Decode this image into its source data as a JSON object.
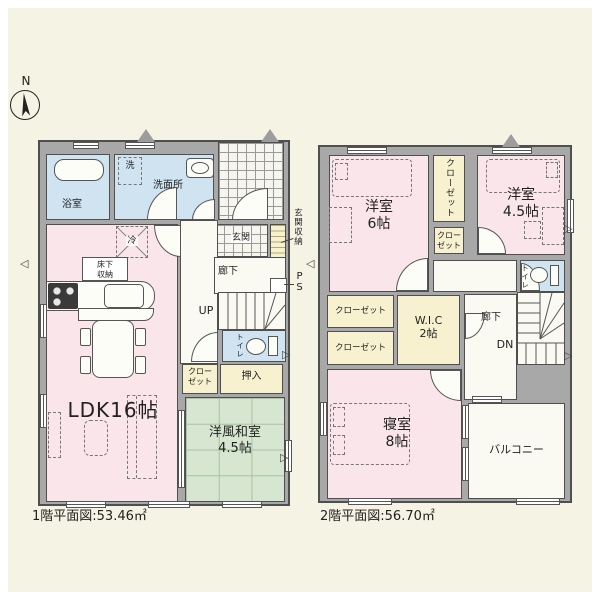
{
  "compass": {
    "north": "N"
  },
  "floor1": {
    "caption": "1階平面図:53.46㎡",
    "labels": {
      "bathroom": "浴室",
      "washer": "洗",
      "washroom": "洗面所",
      "entrance": "玄関",
      "entrance_storage": "玄関収納",
      "hallway": "廊下",
      "pipe_space": "PS",
      "fridge": "冷",
      "underfloor_storage": "床下収納",
      "stairs_up": "UP",
      "toilet": "トイレ",
      "closet": "クローゼット",
      "oshiire": "押入",
      "ldk": "LDK16帖",
      "japanese_room": {
        "line1": "洋風和室",
        "line2": "4.5帖"
      }
    }
  },
  "floor2": {
    "caption": "2階平面図:56.70㎡",
    "labels": {
      "bedroom6": {
        "line1": "洋室",
        "line2": "6帖"
      },
      "closet_tall": "クローゼット",
      "closet_small": "クローゼット",
      "bedroom45": {
        "line1": "洋室",
        "line2": "4.5帖"
      },
      "toilet": "トイレ",
      "hallway": "廊下",
      "stairs_down": "DN",
      "closet_a": "クローゼット",
      "closet_b": "クローゼット",
      "wic": {
        "line1": "W.I.C",
        "line2": "2帖"
      },
      "master_bedroom": {
        "line1": "寝室",
        "line2": "8帖"
      },
      "balcony": "バルコニー"
    }
  },
  "colors": {
    "background": "#f5f3e3",
    "frame": "#ffffff",
    "wall": "#a8a8a8",
    "wall_edge": "#4f4f4f",
    "room_pink": "#f9e5ea",
    "room_blue": "#cfe3f1",
    "room_yellow": "#f7f1cf",
    "room_green": "#d6e6d0",
    "room_white": "#fbfaf2"
  }
}
